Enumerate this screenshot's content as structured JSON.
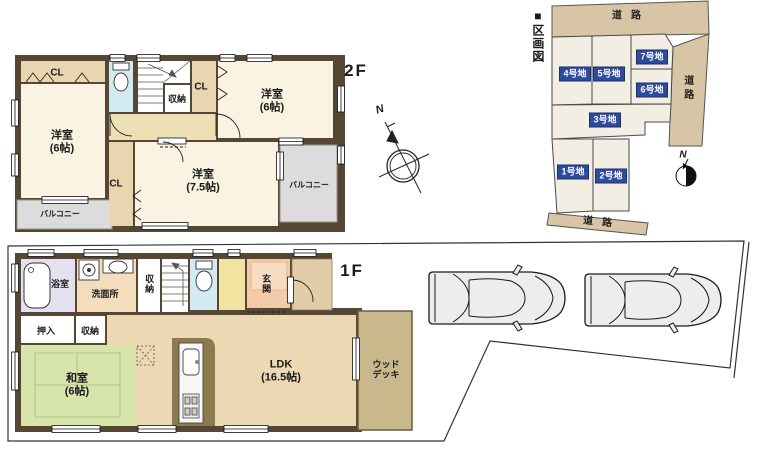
{
  "floor2": {
    "floor_label": "2F",
    "closet_west": "CL",
    "closet_mid": "CL",
    "closet_south": "CL",
    "storage": "収納",
    "room_west": "洋室\n(6帖)",
    "room_east": "洋室\n(6帖)",
    "room_south": "洋室\n(7.5帖)",
    "balcony_sw": "バルコニー",
    "balcony_se": "バルコニー",
    "compass_north": "N"
  },
  "floor1": {
    "floor_label": "1F",
    "bathroom": "浴室",
    "washroom": "洗面所",
    "storage_hall": "収納",
    "entrance": "玄関",
    "oshiire": "押入",
    "storage_tatami": "収納",
    "tatami_room": "和室\n(6帖)",
    "ldk": "LDK\n(16.5帖)",
    "wood_deck": "ウッド\nデッキ"
  },
  "plot_map": {
    "title": "■区画図",
    "road_top": "道路",
    "road_right": "道路",
    "road_bottom": "道路",
    "lots": [
      {
        "label": "1号地"
      },
      {
        "label": "2号地"
      },
      {
        "label": "3号地"
      },
      {
        "label": "4号地"
      },
      {
        "label": "5号地"
      },
      {
        "label": "6号地"
      },
      {
        "label": "7号地"
      }
    ],
    "compass_north": "N"
  },
  "colors": {
    "wall": "#564634",
    "room_cream": "#faf3e1",
    "hall_2f": "#ece0b4",
    "closet_tan": "#e9d6b1",
    "toilet_blue": "#d2eaf2",
    "bath_lavender": "#e4e2f1",
    "washroom_peach": "#f3ddbd",
    "entrance_pink": "#f3cba9",
    "hall_1f_yellow": "#f1e3a0",
    "tatami_green": "#d7e5ab",
    "ldk_tan": "#ecd8b2",
    "wood_deck": "#c9b88c",
    "balcony_gray": "#dcdcdc",
    "kitchen_olive": "#8b7a4e",
    "road_tan": "#d8c5a6",
    "lot_fill": "#f2eee4",
    "lot_badge_blue": "#2d4b9d"
  }
}
